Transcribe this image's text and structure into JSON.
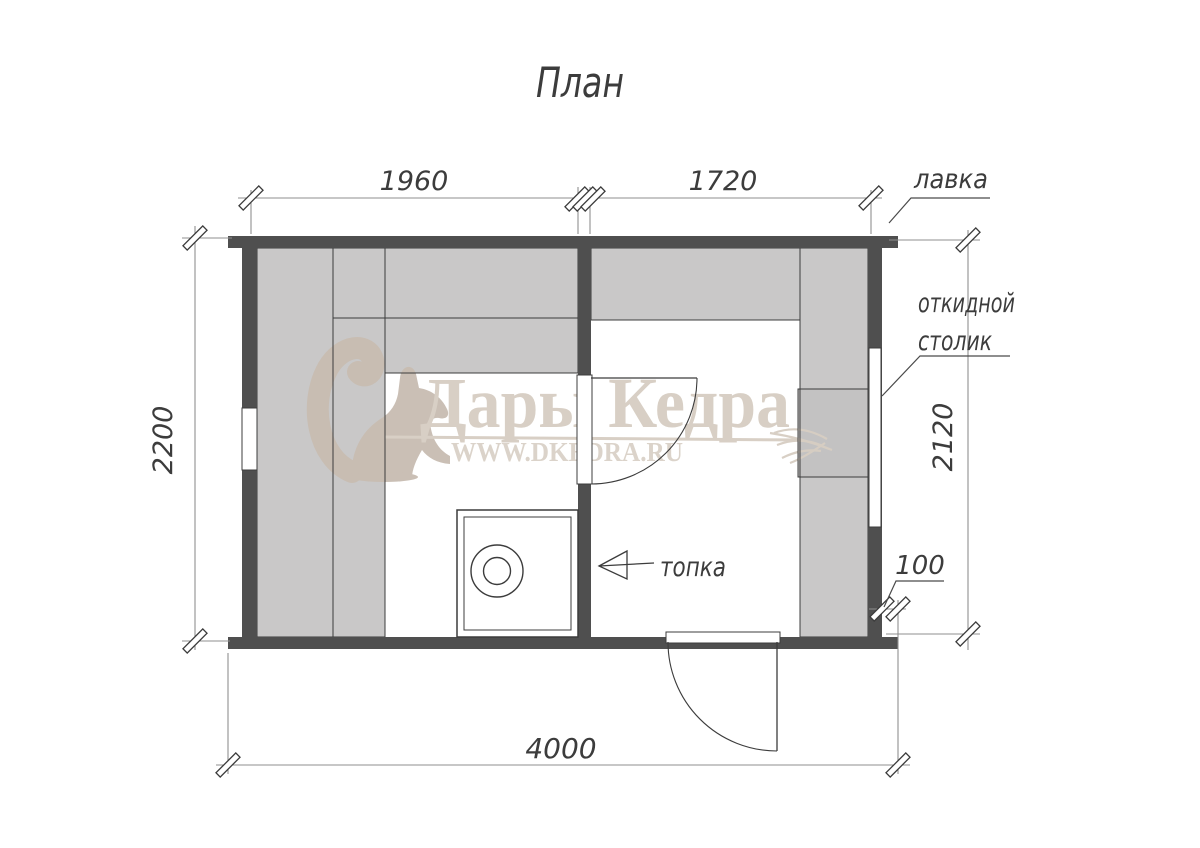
{
  "title": "План",
  "dimensions": {
    "top_left": "1960",
    "top_right": "1720",
    "left": "2200",
    "right": "2120",
    "wall_offset": "100",
    "bottom": "4000"
  },
  "labels": {
    "bench": "лавка",
    "folding_table_line1": "откидной",
    "folding_table_line2": "столик",
    "firebox": "топка"
  },
  "watermark": {
    "brand": "Дары Кедра",
    "url": "WWW.DKEDRA.RU"
  },
  "colors": {
    "wall": "#4f4f4f",
    "bench": "#c9c8c8",
    "bench_mid": "#c3c2c2",
    "outline": "#3c3c3c",
    "dim_line": "#8f8f8f",
    "text": "#3c3c3c",
    "wm_beige": "#c8bdb2",
    "wm_text": "#d7cec3",
    "wm_url": "#dad2c8",
    "background": "#ffffff"
  }
}
